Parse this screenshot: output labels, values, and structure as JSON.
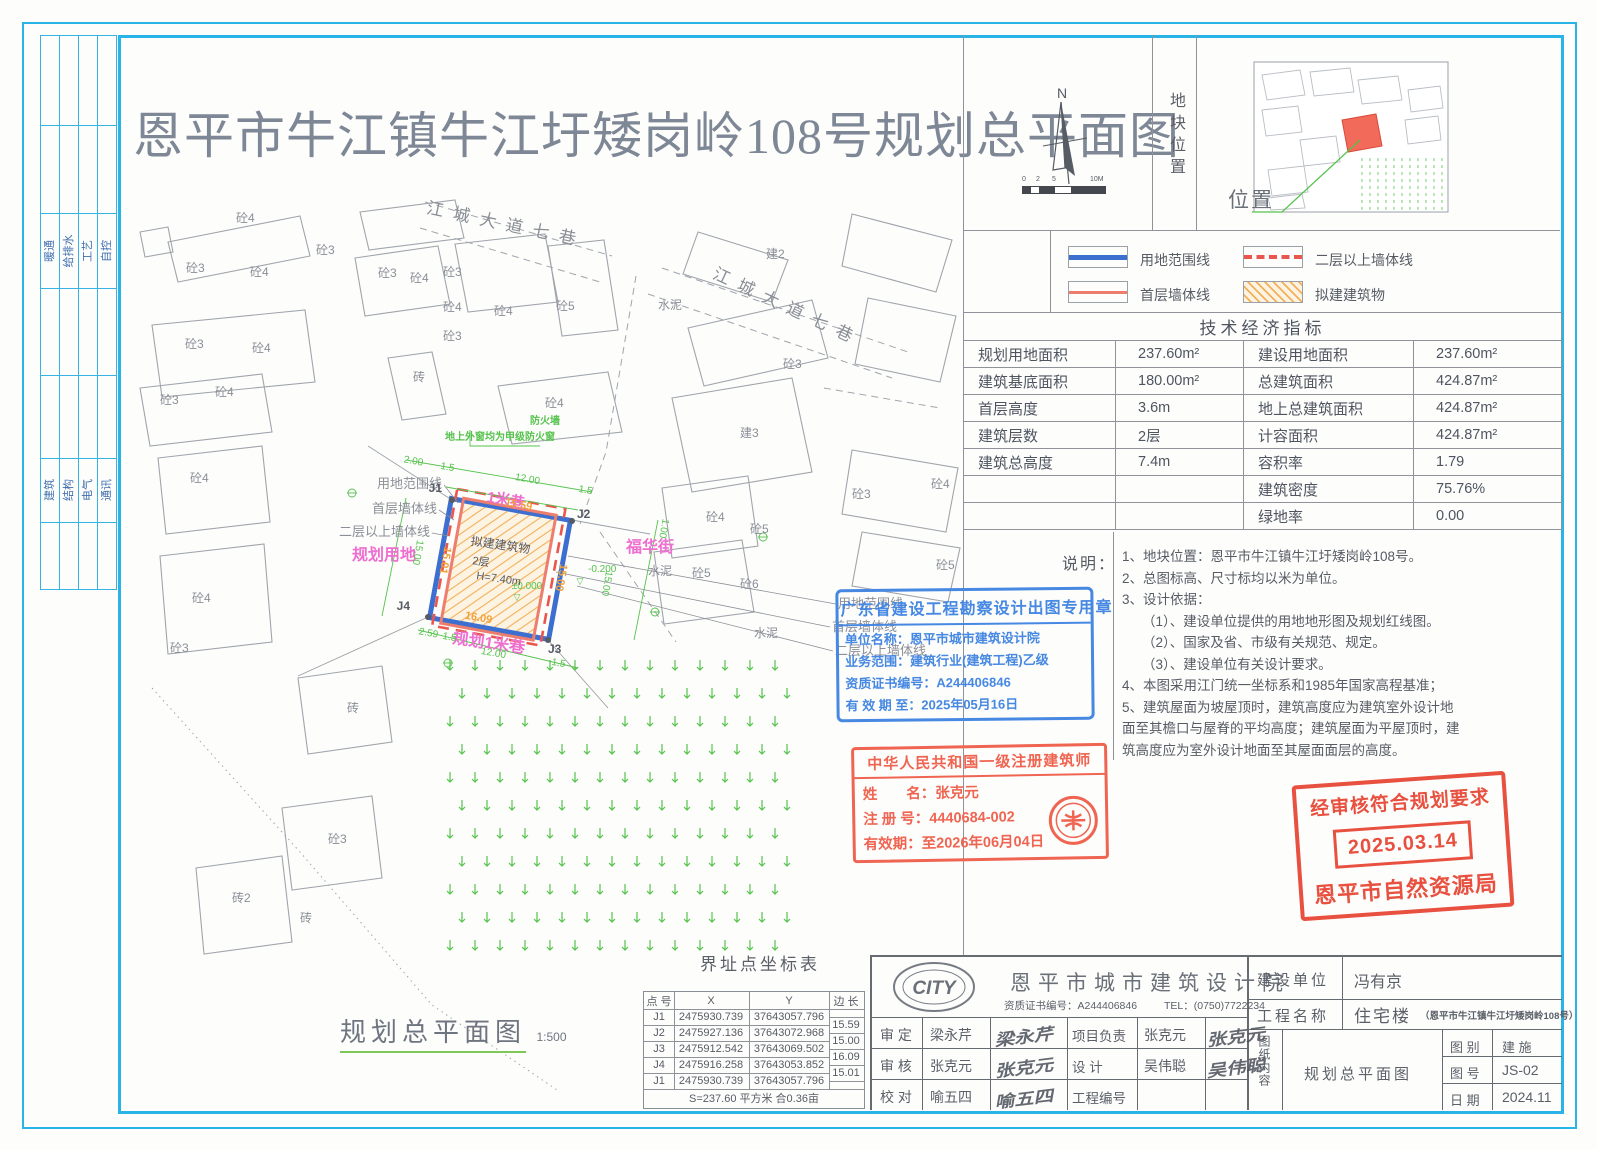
{
  "title": "恩平市牛江镇牛江圩矮岗岭108号规划总平面图",
  "left_strip": {
    "group1": [
      "暖通",
      "给排水",
      "工艺",
      "自控"
    ],
    "group2": [
      "建筑",
      "结构",
      "电气",
      "通讯"
    ]
  },
  "compass": {
    "north": "N",
    "ticks": [
      "0",
      "2",
      "5",
      "10M"
    ]
  },
  "site_location": {
    "vertical_label": "地块位置",
    "position_label": "位置"
  },
  "legend": {
    "items": [
      {
        "label": "用地范围线"
      },
      {
        "label": "二层以上墙体线"
      },
      {
        "label": "首层墙体线"
      },
      {
        "label": "拟建建筑物"
      }
    ]
  },
  "tech": {
    "title": "技术经济指标",
    "rows": [
      {
        "l1": "规划用地面积",
        "v1": "237.60m²",
        "l2": "建设用地面积",
        "v2": "237.60m²"
      },
      {
        "l1": "建筑基底面积",
        "v1": "180.00m²",
        "l2": "总建筑面积",
        "v2": "424.87m²"
      },
      {
        "l1": "首层高度",
        "v1": "3.6m",
        "l2": "地上总建筑面积",
        "v2": "424.87m²"
      },
      {
        "l1": "建筑层数",
        "v1": "2层",
        "l2": "计容面积",
        "v2": "424.87m²"
      },
      {
        "l1": "建筑总高度",
        "v1": "7.4m",
        "l2": "容积率",
        "v2": "1.79"
      },
      {
        "l1": "",
        "v1": "",
        "l2": "建筑密度",
        "v2": "75.76%"
      },
      {
        "l1": "",
        "v1": "",
        "l2": "绿地率",
        "v2": "0.00"
      }
    ]
  },
  "notes": {
    "label": "说明：",
    "lines": [
      "1、地块位置：恩平市牛江镇牛江圩矮岗岭108号。",
      "2、总图标高、尺寸标均以米为单位。",
      "3、设计依据：",
      "（1）、建设单位提供的用地地形图及规划红线图。",
      "（2）、国家及省、市级有关规范、规定。",
      "（3）、建设单位有关设计要求。",
      "4、本图采用江门统一坐标系和1985年国家高程基准；",
      "5、建筑屋面为坡屋顶时，建筑高度应为建筑室外设计地",
      "面至其檐口与屋脊的平均高度；建筑屋面为平屋顶时，建",
      "筑高度应为室外设计地面至其屋面面层的高度。"
    ]
  },
  "stamps": {
    "blue": {
      "title": "广东省建设工程勘察设计出图专用章",
      "line1": "单位名称：恩平市城市建筑设计院",
      "line2": "业务范围：建筑行业(建筑工程)乙级",
      "line3": "资质证书编号：A244406846",
      "line4": "有 效 期 至：2025年05月16日"
    },
    "architect": {
      "title": "中华人民共和国一级注册建筑师",
      "line1": "姓　　名：张克元",
      "line2": "注 册 号：4440684-002",
      "line3": "有效期：至2026年06月04日"
    },
    "approve": {
      "line1": "经审核符合规划要求",
      "date": "2025.03.14",
      "org": "恩平市自然资源局"
    }
  },
  "coord_table": {
    "title": "界址点坐标表",
    "headers": {
      "p": "点 号",
      "x": "X",
      "y": "Y",
      "e": "边 长"
    },
    "rows": [
      {
        "p": "J1",
        "x": "2475930.739",
        "y": "37643057.796"
      },
      {
        "p": "J2",
        "x": "2475927.136",
        "y": "37643072.968"
      },
      {
        "p": "J3",
        "x": "2475912.542",
        "y": "37643069.502"
      },
      {
        "p": "J4",
        "x": "2475916.258",
        "y": "37643053.852"
      },
      {
        "p": "J1",
        "x": "2475930.739",
        "y": "37643057.796"
      }
    ],
    "edges": [
      "15.59",
      "15.00",
      "16.09",
      "15.01"
    ],
    "footer": "S=237.60 平方米 合0.36亩"
  },
  "plan_label": {
    "text": "规划总平面图",
    "scale": "1:500"
  },
  "title_block": {
    "logo": "CITY",
    "company": "恩平市城市建筑设计院",
    "cert": "资质证书编号：A244406846",
    "tel": "TEL：(0750)7722234",
    "rows": [
      {
        "l": "审  定",
        "n": "梁永芹",
        "sig": "梁永芹",
        "l2": "项目负责",
        "n2": "张克元",
        "sig2": "张克元"
      },
      {
        "l": "审  核",
        "n": "张克元",
        "sig": "张克元",
        "l2": "设    计",
        "n2": "吴伟聪",
        "sig2": "吴伟聪"
      },
      {
        "l": "校  对",
        "n": "喻五四",
        "sig": "喻五四",
        "l2": "工程编号",
        "n2": "",
        "sig2": ""
      }
    ],
    "client_label": "建设单位",
    "client": "冯有京",
    "project_label": "工程名称",
    "project": "住宅楼",
    "project_sub": "（恩平市牛江镇牛江圩矮岗岭108号）",
    "content_label": "图纸内容",
    "content": "规划总平面图",
    "cat_label": "图  别",
    "cat": "建  施",
    "no_label": "图  号",
    "no": "JS-02",
    "date_label": "日  期",
    "date": "2024.11"
  },
  "map": {
    "colors": {
      "gray": "#8a8e96",
      "magenta": "#ee6fcf",
      "green": "#55c24c",
      "orange": "#f0a23c",
      "dark": "#565b64"
    },
    "labels": [
      {
        "t": "砼4",
        "x": 236,
        "y": 222
      },
      {
        "t": "砼3",
        "x": 316,
        "y": 254
      },
      {
        "t": "砼3",
        "x": 186,
        "y": 272
      },
      {
        "t": "砼4",
        "x": 250,
        "y": 276
      },
      {
        "t": "砼3",
        "x": 378,
        "y": 277
      },
      {
        "t": "砼4",
        "x": 410,
        "y": 282
      },
      {
        "t": "砼3",
        "x": 443,
        "y": 276
      },
      {
        "t": "砼4",
        "x": 443,
        "y": 311
      },
      {
        "t": "砼3",
        "x": 443,
        "y": 340
      },
      {
        "t": "砼4",
        "x": 494,
        "y": 315
      },
      {
        "t": "砼5",
        "x": 556,
        "y": 310
      },
      {
        "t": "建2",
        "x": 766,
        "y": 258
      },
      {
        "t": "砼3",
        "x": 185,
        "y": 348
      },
      {
        "t": "砼4",
        "x": 252,
        "y": 352
      },
      {
        "t": "砼4",
        "x": 215,
        "y": 396
      },
      {
        "t": "砼3",
        "x": 160,
        "y": 404
      },
      {
        "t": "砖",
        "x": 413,
        "y": 381
      },
      {
        "t": "砼4",
        "x": 545,
        "y": 407
      },
      {
        "t": "砼3",
        "x": 783,
        "y": 368
      },
      {
        "t": "建3",
        "x": 740,
        "y": 437
      },
      {
        "t": "砼3",
        "x": 852,
        "y": 498
      },
      {
        "t": "砼4",
        "x": 706,
        "y": 521
      },
      {
        "t": "砼5",
        "x": 750,
        "y": 533
      },
      {
        "t": "砼5",
        "x": 692,
        "y": 577
      },
      {
        "t": "砼6",
        "x": 740,
        "y": 588
      },
      {
        "t": "砼4",
        "x": 931,
        "y": 488
      },
      {
        "t": "砼5",
        "x": 936,
        "y": 569
      },
      {
        "t": "砼4",
        "x": 190,
        "y": 482
      },
      {
        "t": "砼4",
        "x": 192,
        "y": 602
      },
      {
        "t": "砼3",
        "x": 170,
        "y": 652
      },
      {
        "t": "砖",
        "x": 347,
        "y": 712
      },
      {
        "t": "砼3",
        "x": 328,
        "y": 843
      },
      {
        "t": "砖2",
        "x": 232,
        "y": 902
      },
      {
        "t": "砖",
        "x": 300,
        "y": 922
      },
      {
        "t": "水泥",
        "x": 658,
        "y": 309
      },
      {
        "t": "水泥",
        "x": 648,
        "y": 575
      },
      {
        "t": "水泥",
        "x": 754,
        "y": 637
      },
      {
        "t": "防火墙",
        "x": 545,
        "y": 424,
        "c": "green",
        "s": 10,
        "b": 1,
        "a": "middle"
      },
      {
        "t": "地上外窗均为甲级防火窗",
        "x": 500,
        "y": 440,
        "c": "green",
        "s": 10,
        "b": 1,
        "a": "middle"
      },
      {
        "t": "江城大道七巷",
        "x": 505,
        "y": 230,
        "s": 17,
        "ls": 10,
        "r": 12,
        "a": "middle"
      },
      {
        "t": "江城大道七巷",
        "x": 785,
        "y": 312,
        "s": 17,
        "ls": 10,
        "r": 25,
        "a": "middle"
      },
      {
        "t": "1米巷",
        "x": 505,
        "y": 505,
        "c": "magenta",
        "s": 15,
        "r": 10,
        "a": "middle",
        "b": 1
      },
      {
        "t": "福华街",
        "x": 626,
        "y": 552,
        "c": "magenta",
        "s": 16,
        "b": 1
      },
      {
        "t": "规划用地",
        "x": 352,
        "y": 560,
        "c": "magenta",
        "s": 16,
        "b": 1
      },
      {
        "t": "规划1米巷",
        "x": 452,
        "y": 643,
        "c": "magenta",
        "s": 16,
        "r": 8,
        "b": 1
      },
      {
        "t": "用地范围线",
        "x": 442,
        "y": 488,
        "a": "end",
        "s": 13
      },
      {
        "t": "首层墙体线",
        "x": 437,
        "y": 513,
        "a": "end",
        "s": 13
      },
      {
        "t": "二层以上墙体线",
        "x": 430,
        "y": 536,
        "a": "end",
        "s": 13
      },
      {
        "t": "用地范围线",
        "x": 838,
        "y": 608,
        "s": 13
      },
      {
        "t": "首层墙体线",
        "x": 832,
        "y": 631,
        "s": 13
      },
      {
        "t": "二层以上墙体线",
        "x": 835,
        "y": 655,
        "s": 13
      },
      {
        "t": "15.59",
        "x": 518,
        "y": 508,
        "c": "orange",
        "s": 11,
        "r": 10,
        "b": 1,
        "a": "middle"
      },
      {
        "t": "15.00",
        "x": 558,
        "y": 577,
        "c": "orange",
        "s": 11,
        "r": 100,
        "b": 1,
        "a": "middle"
      },
      {
        "t": "16.09",
        "x": 478,
        "y": 621,
        "c": "orange",
        "s": 11,
        "r": 10,
        "b": 1,
        "a": "middle"
      },
      {
        "t": "15.01",
        "x": 442,
        "y": 560,
        "c": "orange",
        "s": 11,
        "r": 100,
        "b": 1,
        "a": "middle"
      },
      {
        "t": "2.00",
        "x": 413,
        "y": 464,
        "c": "green",
        "s": 10,
        "r": 10,
        "a": "middle"
      },
      {
        "t": "1.5",
        "x": 447,
        "y": 470,
        "c": "green",
        "s": 10,
        "r": 10,
        "a": "middle"
      },
      {
        "t": "12.00",
        "x": 527,
        "y": 482,
        "c": "green",
        "s": 10,
        "r": 10,
        "a": "middle"
      },
      {
        "t": "1.5",
        "x": 585,
        "y": 493,
        "c": "green",
        "s": 10,
        "r": 10,
        "a": "middle"
      },
      {
        "t": "1.00",
        "x": 661,
        "y": 528,
        "c": "green",
        "s": 10,
        "r": 100,
        "a": "middle"
      },
      {
        "t": "15.00",
        "x": 415,
        "y": 552,
        "c": "green",
        "s": 10,
        "r": 100,
        "a": "middle"
      },
      {
        "t": "15.00",
        "x": 604,
        "y": 583,
        "c": "green",
        "s": 10,
        "r": 100,
        "a": "middle"
      },
      {
        "t": "-0.200",
        "x": 588,
        "y": 572,
        "c": "green",
        "s": 10
      },
      {
        "t": "±0.000",
        "x": 527,
        "y": 589,
        "c": "green",
        "s": 10,
        "a": "middle"
      },
      {
        "t": "▽",
        "x": 580,
        "y": 584,
        "c": "green",
        "s": 9,
        "a": "middle"
      },
      {
        "t": "▽",
        "x": 517,
        "y": 600,
        "c": "green",
        "s": 9,
        "a": "middle"
      },
      {
        "t": "2.59",
        "x": 428,
        "y": 636,
        "c": "green",
        "s": 10,
        "r": 10,
        "a": "middle"
      },
      {
        "t": "1.5",
        "x": 449,
        "y": 640,
        "c": "green",
        "s": 10,
        "r": 10,
        "a": "middle"
      },
      {
        "t": "12.00",
        "x": 493,
        "y": 656,
        "c": "green",
        "s": 10,
        "r": 10,
        "a": "middle"
      },
      {
        "t": "1.5",
        "x": 558,
        "y": 666,
        "c": "green",
        "s": 10,
        "r": 10,
        "a": "middle"
      },
      {
        "t": "拟建建筑物",
        "x": 500,
        "y": 549,
        "c": "dark",
        "s": 12,
        "r": 8,
        "a": "middle"
      },
      {
        "t": "2层",
        "x": 472,
        "y": 564,
        "c": "dark",
        "s": 11,
        "r": 8
      },
      {
        "t": "H=7.40m",
        "x": 476,
        "y": 579,
        "c": "dark",
        "s": 11,
        "r": 8
      },
      {
        "t": "J1",
        "x": 442,
        "y": 492,
        "c": "dark",
        "s": 12,
        "b": 1,
        "a": "end"
      },
      {
        "t": "J2",
        "x": 577,
        "y": 518,
        "c": "dark",
        "s": 12,
        "b": 1
      },
      {
        "t": "J3",
        "x": 548,
        "y": 653,
        "c": "dark",
        "s": 12,
        "b": 1
      },
      {
        "t": "J4",
        "x": 410,
        "y": 610,
        "c": "dark",
        "s": 12,
        "b": 1,
        "a": "end"
      }
    ]
  }
}
